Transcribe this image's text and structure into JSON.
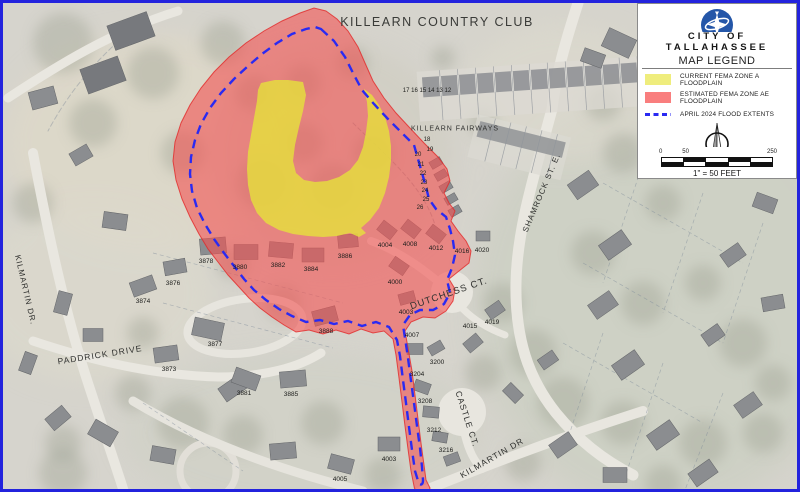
{
  "map": {
    "labels": {
      "streets": [
        {
          "text": "KILLEARN COUNTRY CLUB",
          "x": 434,
          "y": 19,
          "rot": 0,
          "size": 12.5,
          "cls": "lbl-title"
        },
        {
          "text": "KILLEARN FAIRWAYS",
          "x": 452,
          "y": 126,
          "rot": 0,
          "size": 7,
          "cls": "lbl-street"
        },
        {
          "text": "SHAMROCK ST. E.",
          "x": 539,
          "y": 190,
          "rot": -67,
          "size": 8,
          "cls": "lbl-street"
        },
        {
          "text": "DUTCHESS CT.",
          "x": 446,
          "y": 291,
          "rot": -19,
          "size": 9.5,
          "cls": "lbl-street"
        },
        {
          "text": "KILMARTIN DR.",
          "x": 22,
          "y": 287,
          "rot": 77,
          "size": 8,
          "cls": "lbl-street"
        },
        {
          "text": "PADDRICK DRIVE",
          "x": 97,
          "y": 352,
          "rot": -9,
          "size": 8.5,
          "cls": "lbl-street"
        },
        {
          "text": "CASTLE CT.",
          "x": 464,
          "y": 416,
          "rot": 72,
          "size": 8.5,
          "cls": "lbl-street"
        },
        {
          "text": "KILMARTIN DR",
          "x": 489,
          "y": 455,
          "rot": -30,
          "size": 8.5,
          "cls": "lbl-street"
        }
      ],
      "lots": [
        {
          "text": "17 16 15 14 13 12",
          "x": 424,
          "y": 88,
          "rot": 0,
          "size": 6,
          "cls": "lbl-lot"
        },
        {
          "text": "18",
          "x": 424,
          "y": 137,
          "rot": 0,
          "size": 6,
          "cls": "lbl-lot"
        },
        {
          "text": "19",
          "x": 427,
          "y": 147,
          "rot": 0,
          "size": 6,
          "cls": "lbl-lot"
        },
        {
          "text": "20",
          "x": 415,
          "y": 152,
          "rot": 0,
          "size": 6,
          "cls": "lbl-lot"
        },
        {
          "text": "21",
          "x": 418,
          "y": 162,
          "rot": 0,
          "size": 6,
          "cls": "lbl-lot"
        },
        {
          "text": "22",
          "x": 420,
          "y": 171,
          "rot": 0,
          "size": 6,
          "cls": "lbl-lot"
        },
        {
          "text": "23",
          "x": 421,
          "y": 180,
          "rot": 0,
          "size": 6,
          "cls": "lbl-lot"
        },
        {
          "text": "24",
          "x": 422,
          "y": 188,
          "rot": 0,
          "size": 6,
          "cls": "lbl-lot"
        },
        {
          "text": "25",
          "x": 423,
          "y": 197,
          "rot": 0,
          "size": 6,
          "cls": "lbl-lot"
        },
        {
          "text": "26",
          "x": 417,
          "y": 205,
          "rot": 0,
          "size": 6,
          "cls": "lbl-lot"
        }
      ],
      "houses": [
        {
          "text": "3886",
          "x": 342,
          "y": 254
        },
        {
          "text": "4004",
          "x": 382,
          "y": 243
        },
        {
          "text": "4008",
          "x": 407,
          "y": 242
        },
        {
          "text": "4012",
          "x": 433,
          "y": 246
        },
        {
          "text": "4016",
          "x": 459,
          "y": 249
        },
        {
          "text": "4020",
          "x": 479,
          "y": 248
        },
        {
          "text": "4000",
          "x": 392,
          "y": 280
        },
        {
          "text": "4003",
          "x": 403,
          "y": 310
        },
        {
          "text": "4007",
          "x": 409,
          "y": 333
        },
        {
          "text": "4015",
          "x": 467,
          "y": 324
        },
        {
          "text": "4019",
          "x": 489,
          "y": 320
        },
        {
          "text": "3878",
          "x": 203,
          "y": 259
        },
        {
          "text": "3880",
          "x": 237,
          "y": 265
        },
        {
          "text": "3882",
          "x": 275,
          "y": 263
        },
        {
          "text": "3884",
          "x": 308,
          "y": 267
        },
        {
          "text": "3876",
          "x": 170,
          "y": 281
        },
        {
          "text": "3874",
          "x": 140,
          "y": 299
        },
        {
          "text": "3888",
          "x": 323,
          "y": 329
        },
        {
          "text": "3877",
          "x": 212,
          "y": 342
        },
        {
          "text": "3873",
          "x": 166,
          "y": 367
        },
        {
          "text": "3881",
          "x": 241,
          "y": 391
        },
        {
          "text": "3885",
          "x": 288,
          "y": 392
        },
        {
          "text": "3200",
          "x": 434,
          "y": 360
        },
        {
          "text": "3204",
          "x": 414,
          "y": 372
        },
        {
          "text": "3208",
          "x": 422,
          "y": 399
        },
        {
          "text": "3212",
          "x": 431,
          "y": 428
        },
        {
          "text": "3216",
          "x": 443,
          "y": 448
        },
        {
          "text": "4003",
          "x": 386,
          "y": 457
        },
        {
          "text": "4005",
          "x": 337,
          "y": 477
        }
      ]
    }
  },
  "legend": {
    "org_line1": "CITY OF",
    "org_line2": "TALLAHASSEE",
    "title": "MAP LEGEND",
    "items": [
      {
        "key": "zone_a",
        "label": "CURRENT FEMA ZONE A FLOODPLAIN"
      },
      {
        "key": "zone_ae",
        "label": "ESTIMATED FEMA ZONE AE FLOODPLAIN"
      },
      {
        "key": "flood_extents",
        "label": "APRIL 2024 FLOOD EXTENTS"
      }
    ],
    "scale_ticks": [
      "0",
      "50",
      "250"
    ],
    "scale_caption": "1\" = 50 FEET"
  },
  "colors": {
    "map_border": "#2323dd",
    "zone_a_fill": "rgba(230,228,60,0.8)",
    "zone_ae_fill": "rgba(243,82,82,0.6)",
    "zone_ae_stroke": "rgba(226,40,40,0.8)",
    "flood_line": "#2a2af2",
    "legend_zone_a": "#efed7d",
    "legend_zone_ae": "#f97e7e",
    "logo_blue": "#2456a8"
  }
}
